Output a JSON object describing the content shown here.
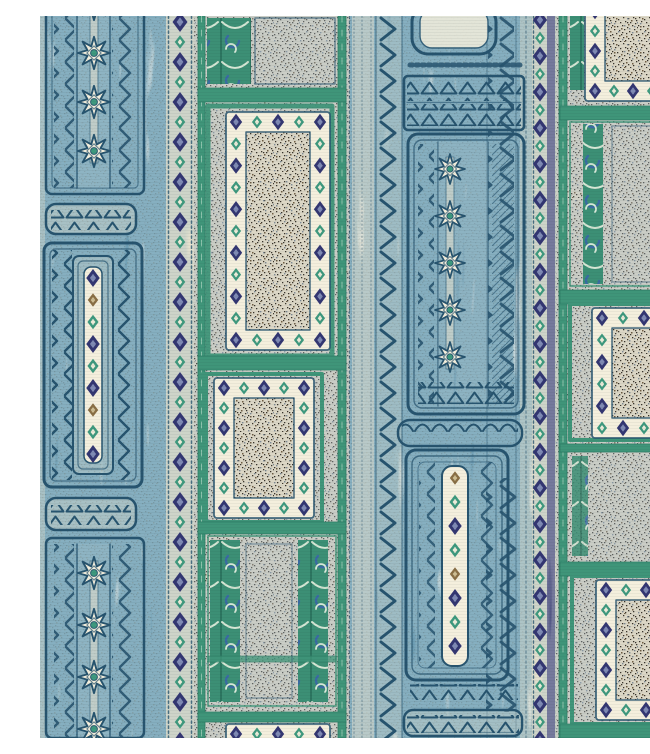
{
  "artwork": {
    "title": "Indigo batik-style striped fabric with star, diamond and speckled tweed panels",
    "type": "textile-pattern"
  },
  "palette": {
    "cream": "#e9e3cf",
    "cream2": "#f4efdd",
    "blue": "#4e7d9a",
    "bluepale": "#a9c3cd",
    "ink": "#27546f",
    "navy": "#333672",
    "teal": "#3e997e",
    "teal2": "#3c8f75",
    "green": "#3f9579",
    "ochre": "#8a6f45",
    "speckbg": "#dcd7c6",
    "speckdark": "#38332b",
    "speckbrown": "#6e5c42",
    "speckslate": "#7d8a95"
  },
  "stripes": [
    {
      "name": "blue-motif-stripe-left",
      "x": 0,
      "width": 128
    },
    {
      "name": "diamond-chain-stripe-left",
      "x": 126,
      "width": 28
    },
    {
      "name": "speckled-panel-column-left",
      "x": 154,
      "width": 158
    },
    {
      "name": "blue-motif-stripe-center",
      "x": 310,
      "width": 182
    },
    {
      "name": "diamond-chain-stripe-right",
      "x": 492,
      "width": 26
    },
    {
      "name": "speckled-panel-column-right",
      "x": 516,
      "width": 134
    }
  ],
  "decorations": {
    "star_columns": [
      {
        "x": 54,
        "y": -12,
        "step": 49,
        "count": 4,
        "scale": 0.95
      },
      {
        "x": 54,
        "y": 557,
        "step": 52,
        "count": 4,
        "scale": 0.95
      },
      {
        "x": 410,
        "y": 153,
        "step": 47,
        "count": 5,
        "scale": 0.88
      }
    ],
    "dot_columns": [
      {
        "x": 53,
        "y": 262,
        "step": 22,
        "seq": [
          "N",
          "O",
          "T",
          "N",
          "T",
          "N",
          "O",
          "T",
          "N"
        ]
      },
      {
        "x": 415,
        "y": 462,
        "step": 24,
        "seq": [
          "O",
          "T",
          "N",
          "T",
          "O",
          "N",
          "T",
          "N"
        ]
      }
    ],
    "chain_stripes": [
      {
        "x": 140,
        "y": 6,
        "step": 40,
        "count": 19,
        "big": 1,
        "small": 0.85
      },
      {
        "x": 500,
        "y": 4,
        "step": 36,
        "count": 21,
        "big": 0.95,
        "small": 0.8
      }
    ],
    "diamond_frames": [
      {
        "x": 186,
        "y": 96,
        "w": 104,
        "h": 238
      },
      {
        "x": 174,
        "y": 362,
        "w": 100,
        "h": 140
      },
      {
        "x": 186,
        "y": 708,
        "w": 104,
        "h": 54
      },
      {
        "x": 545,
        "y": -55,
        "w": 115,
        "h": 140
      },
      {
        "x": 552,
        "y": 292,
        "w": 104,
        "h": 130
      },
      {
        "x": 556,
        "y": 564,
        "w": 100,
        "h": 140
      }
    ]
  }
}
